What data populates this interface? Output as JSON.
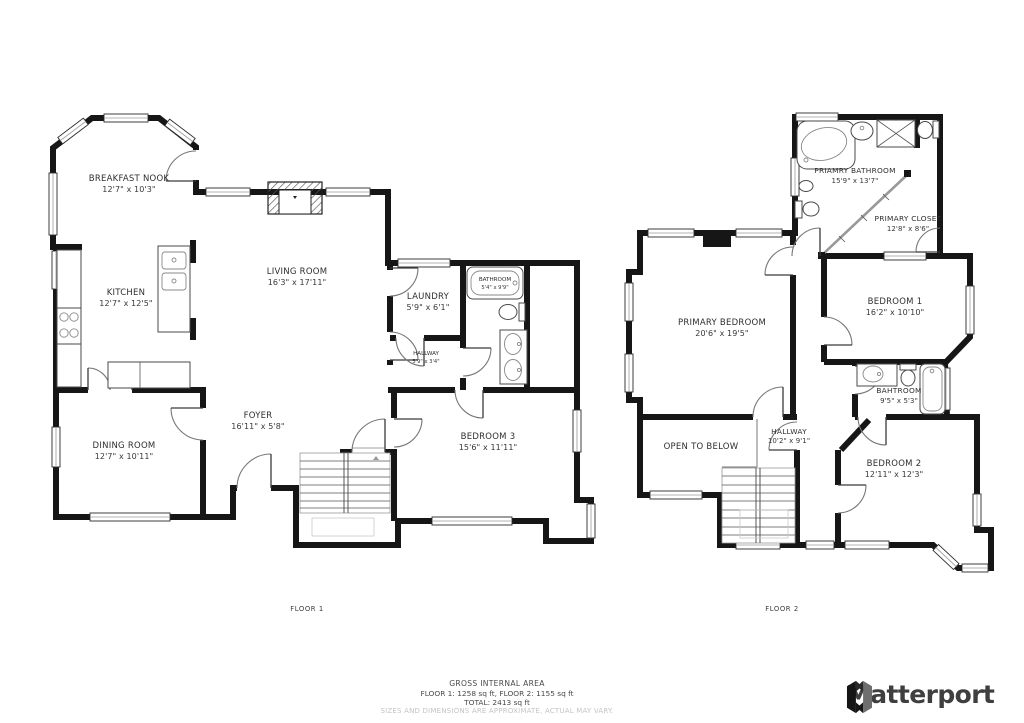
{
  "title": "Floor plan",
  "colors": {
    "wall": "#161616",
    "label": "#2e2e2e",
    "disclaimer": "#c4c4c4",
    "brand_text": "#3f3f3f"
  },
  "floor1": {
    "caption": "FLOOR 1",
    "rooms": [
      {
        "name": "BREAKFAST NOOK",
        "dims": "12'7\" x 10'3\""
      },
      {
        "name": "KITCHEN",
        "dims": "12'7\" x 12'5\""
      },
      {
        "name": "LIVING ROOM",
        "dims": "16'3\" x 17'11\""
      },
      {
        "name": "LAUNDRY",
        "dims": "5'9\" x 6'1\""
      },
      {
        "name": "BATHROOM",
        "dims": "5'4\" x 9'9\""
      },
      {
        "name": "HALLWAY",
        "dims": "5'9\" x 3'4\""
      },
      {
        "name": "FOYER",
        "dims": "16'11\" x 5'8\""
      },
      {
        "name": "DINING ROOM",
        "dims": "12'7\" x 10'11\""
      },
      {
        "name": "BEDROOM 3",
        "dims": "15'6\" x 11'11\""
      }
    ]
  },
  "floor2": {
    "caption": "FLOOR 2",
    "rooms": [
      {
        "name": "PRIAMRY BATHROOM",
        "dims": "15'9\" x 13'7\""
      },
      {
        "name": "PRIMARY CLOSET",
        "dims": "12'8\" x 8'6\""
      },
      {
        "name": "PRIMARY BEDROOM",
        "dims": "20'6\" x 19'5\""
      },
      {
        "name": "BEDROOM 1",
        "dims": "16'2\" x 10'10\""
      },
      {
        "name": "BAHTROOM",
        "dims": "9'5\" x 5'3\""
      },
      {
        "name": "HALLWAY",
        "dims": "10'2\" x 9'1\""
      },
      {
        "name": "OPEN TO BELOW",
        "dims": ""
      },
      {
        "name": "BEDROOM 2",
        "dims": "12'11\" x 12'3\""
      }
    ]
  },
  "footer": {
    "area_title": "GROSS INTERNAL AREA",
    "area_line1": "FLOOR 1: 1258 sq ft, FLOOR 2: 1155 sq ft",
    "area_line2": "TOTAL: 2413 sq ft",
    "disclaimer": "SIZES AND DIMENSIONS ARE APPROXIMATE, ACTUAL MAY VARY.",
    "brand": "Matterport"
  }
}
